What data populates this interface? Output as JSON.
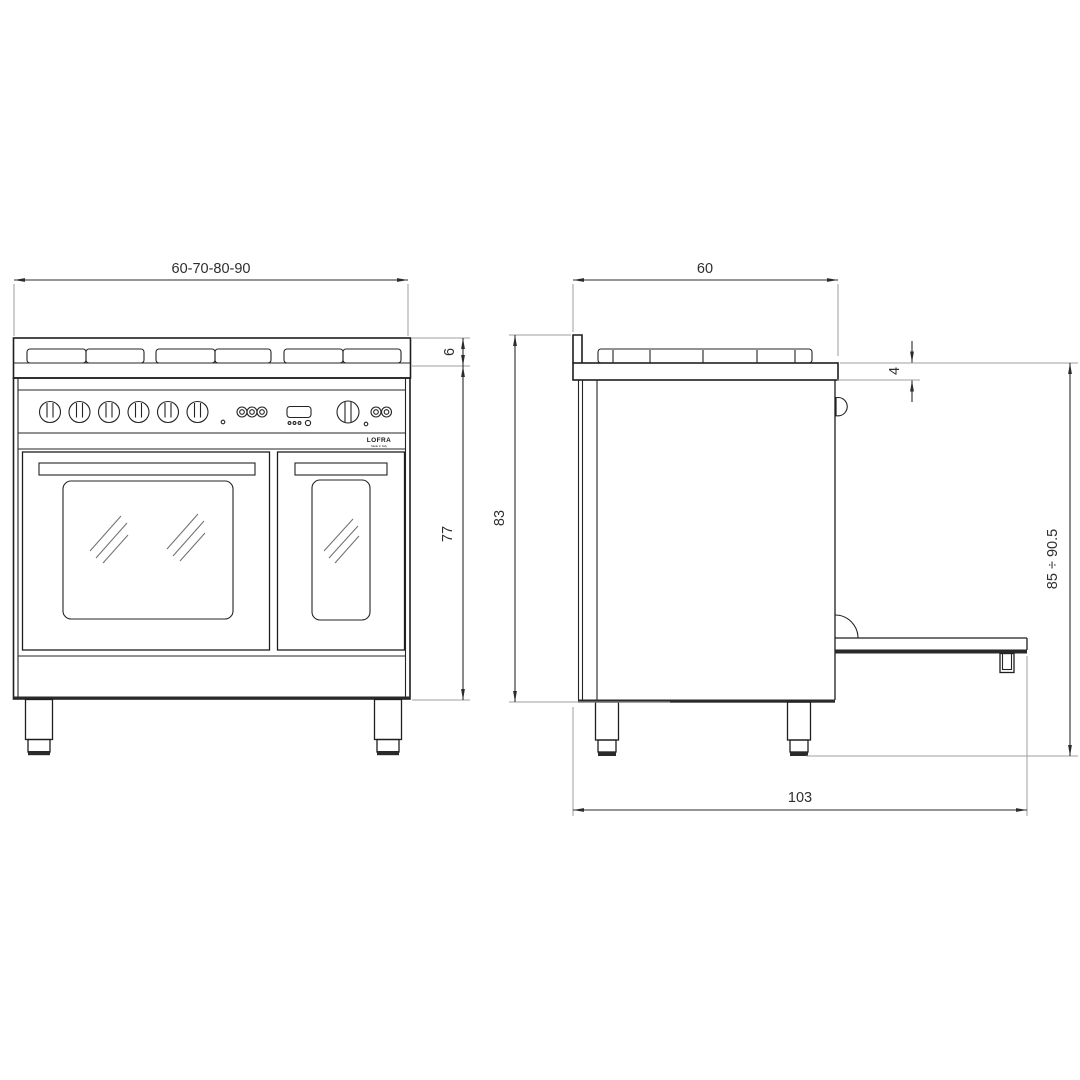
{
  "brand": {
    "name": "LOFRA",
    "tagline": "Made in Italy"
  },
  "dimensions": {
    "front": {
      "width": "60-70-80-90",
      "hob_height": "6",
      "body_height": "77"
    },
    "side": {
      "depth": "60",
      "worktop_thickness": "4",
      "height_to_hob_back": "83",
      "overall_height_range": "85 ÷ 90.5",
      "depth_door_open": "103"
    }
  },
  "colors": {
    "line": "#1e1e1e",
    "dimension": "#2b2b2b",
    "extension": "#9f9f9f",
    "background": "#ffffff"
  }
}
